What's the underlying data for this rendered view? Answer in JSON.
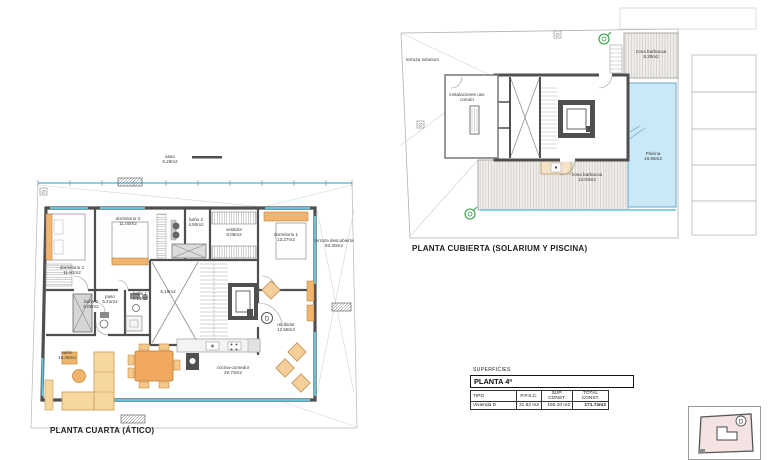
{
  "sheet": {
    "background": "#ffffff"
  },
  "colors": {
    "wall": "#4f4f4f",
    "glazing": "#62c4dc",
    "pool_fill": "#c9e9f6",
    "furniture_tan": "#f2b46e",
    "green_marker": "#2f9e44",
    "keyplan_fill": "#f3e3e3"
  },
  "plan_atico": {
    "title": "PLANTA CUARTA (ÁTICO)",
    "roof_annex": {
      "name": "aseo",
      "area": "5.29m2"
    },
    "rooms": [
      {
        "name": "dormitorio 3",
        "area": "11.00m2"
      },
      {
        "name": "baño 2",
        "area": "4.90m2"
      },
      {
        "name": "vestidor",
        "area": "8.05m2"
      },
      {
        "name": "dormitorio 1",
        "area": "13.27m2"
      },
      {
        "name": "terraza descubierta",
        "area": "83.30m2"
      },
      {
        "name": "dormitorio 2",
        "area": "11.91m2"
      },
      {
        "name": "baño 3",
        "area": "5.09m2"
      },
      {
        "name": "paso",
        "area": "5.21m2"
      },
      {
        "name": "baño 1",
        "area": "4.14m2"
      },
      {
        "name": "",
        "area": "5.19m2"
      },
      {
        "name": "recibidor",
        "area": "12.58m2"
      },
      {
        "name": "salón",
        "area": "16.45m2"
      },
      {
        "name": "cocina-comedor",
        "area": "20.73m2"
      }
    ],
    "entrance_marker": "D"
  },
  "plan_cubierta": {
    "title": "PLANTA CUBIERTA (SOLARIUM Y PISCINA)",
    "zones": [
      {
        "name": "terraza solarium",
        "area": ""
      },
      {
        "name": "zona barbacoa",
        "area": "9.30m2"
      },
      {
        "name": "instalaciones uso común",
        "area": ""
      },
      {
        "name": "Piscina",
        "area": "16.96m2"
      },
      {
        "name": "zona barbacoa",
        "area": "13.03m2"
      }
    ]
  },
  "summary": {
    "section_label": "SUPERFICIES",
    "floor_label": "PLANTA 4ª",
    "columns": [
      "TIPO",
      "P.P.S.C.",
      "SUP. CONST.",
      "TOTAL CONST."
    ],
    "row": {
      "tipo": "Vivienda D",
      "ppsc": "21.62 m2",
      "sup_const": "150.10 m2",
      "total_const": "171.72m2"
    }
  },
  "key_plan": {
    "unit_marker": "D"
  },
  "symbols": {
    "diameter": "∅"
  }
}
